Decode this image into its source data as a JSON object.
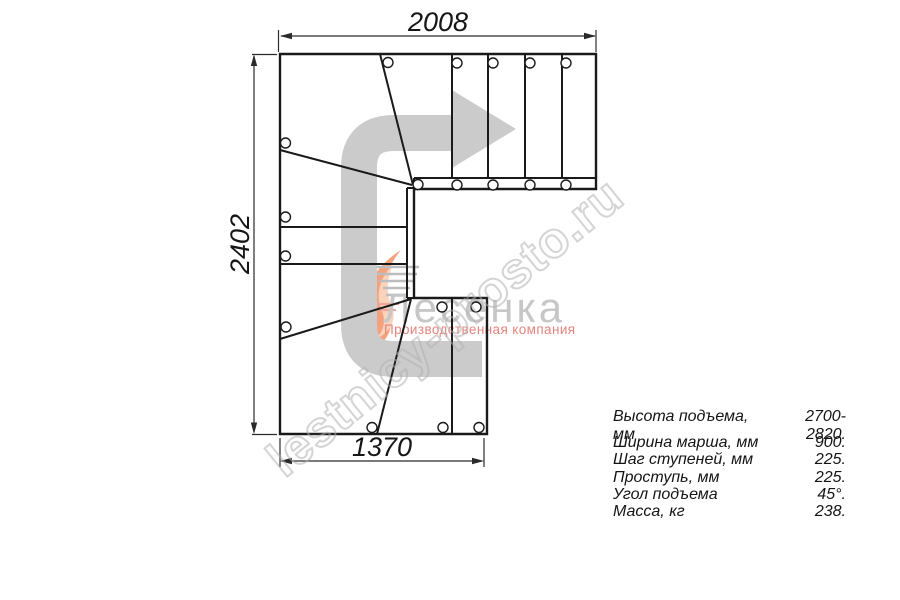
{
  "drawing": {
    "type": "staircase-floor-plan",
    "dim_top": "2008",
    "dim_left": "2402",
    "dim_bottom": "1370",
    "line_color": "#1a1a1a",
    "direction_arrow_color": "#cbcbcb"
  },
  "watermark": {
    "site_text": "lestnicy-prosto.ru",
    "outline_color": "#b2b2b2"
  },
  "logo": {
    "name": "Лесенка",
    "subtitle": "Производственная компания",
    "name_color": "#c7c7c7",
    "subtitle_color": "#e4837c",
    "flame_color": "#f2a37e"
  },
  "specs": {
    "rows": [
      {
        "label": "Высота подъема, мм",
        "value": "2700-2820."
      },
      {
        "label": "Ширина марша, мм",
        "value": "900."
      },
      {
        "label": "Шаг ступеней, мм",
        "value": "225."
      },
      {
        "label": "Проступь, мм",
        "value": "225."
      },
      {
        "label": "Угол подъема",
        "value": "45°."
      },
      {
        "label": "Масса, кг",
        "value": "238."
      }
    ]
  }
}
